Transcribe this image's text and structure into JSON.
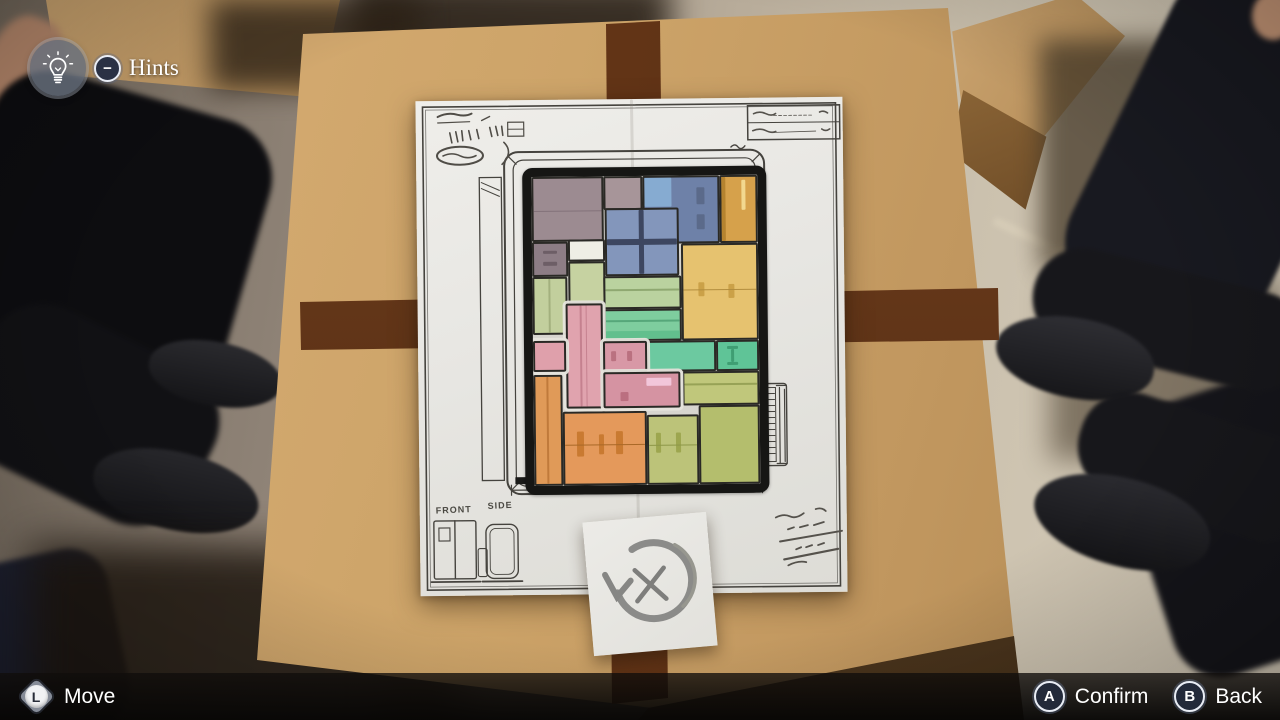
{
  "hud": {
    "hints_label": "Hints",
    "hints_button_glyph": "−",
    "controls": [
      {
        "button": "L",
        "label": "Move",
        "type": "stick"
      },
      {
        "button": "A",
        "label": "Confirm",
        "type": "face-button"
      },
      {
        "button": "B",
        "label": "Back",
        "type": "face-button"
      }
    ]
  },
  "blueprint": {
    "front_label": "FRONT",
    "side_label": "SIDE",
    "note_icon": "rotate-crossed-out",
    "blocks": [
      {
        "name": "mauve-large",
        "x": 0,
        "y": 0,
        "w": 32,
        "h": 21,
        "color": "#9c8b91",
        "marks": [
          {
            "x": 0,
            "y": 52,
            "w": 100,
            "h": 3,
            "c": "#83727a"
          }
        ]
      },
      {
        "name": "mauve-light",
        "x": 32,
        "y": 0,
        "w": 17,
        "h": 11,
        "color": "#a79599",
        "marks": []
      },
      {
        "name": "blue-large",
        "x": 49,
        "y": 0,
        "w": 34,
        "h": 22,
        "color": "#6e81a8",
        "marks": [
          {
            "x": 0,
            "y": 0,
            "w": 37,
            "h": 46,
            "c": "#86abd1"
          },
          {
            "x": 72,
            "y": 16,
            "w": 11,
            "h": 26,
            "c": "#5b6a8a"
          },
          {
            "x": 72,
            "y": 58,
            "w": 11,
            "h": 24,
            "c": "#5b6a8a"
          }
        ]
      },
      {
        "name": "amber-tall",
        "x": 83,
        "y": 0,
        "w": 17,
        "h": 22,
        "color": "#d6a14b",
        "marks": [
          {
            "x": 0,
            "y": 0,
            "w": 12,
            "h": 100,
            "c": "#b5832f"
          },
          {
            "x": 58,
            "y": 4,
            "w": 13,
            "h": 48,
            "c": "#f2d88f"
          }
        ]
      },
      {
        "name": "blue-grid",
        "x": 32.5,
        "y": 10.5,
        "w": 32.5,
        "h": 22,
        "color": "#8396bb",
        "marks": [
          {
            "x": 46,
            "y": 0,
            "w": 7,
            "h": 100,
            "c": "#3d4660"
          },
          {
            "x": 0,
            "y": 45,
            "w": 100,
            "h": 9,
            "c": "#3d4660"
          }
        ]
      },
      {
        "name": "mauve-drawers",
        "x": 0,
        "y": 21,
        "w": 16,
        "h": 11.5,
        "color": "#8d7d85",
        "marks": [
          {
            "x": 28,
            "y": 22,
            "w": 44,
            "h": 11,
            "c": "#6d5e66"
          },
          {
            "x": 28,
            "y": 58,
            "w": 44,
            "h": 11,
            "c": "#6d5e66"
          }
        ]
      },
      {
        "name": "white-box",
        "x": 16,
        "y": 20.5,
        "w": 16.5,
        "h": 7,
        "color": "#efeee5",
        "marks": []
      },
      {
        "name": "green-below-white",
        "x": 16,
        "y": 27.5,
        "w": 16.5,
        "h": 13.5,
        "color": "#c6d2a1",
        "marks": []
      },
      {
        "name": "green-left",
        "x": 0,
        "y": 32.5,
        "w": 15.5,
        "h": 18.5,
        "color": "#c2cf9d",
        "marks": [
          {
            "x": 46,
            "y": 0,
            "w": 6,
            "h": 100,
            "c": "#a3b07e"
          }
        ]
      },
      {
        "name": "green-horiz",
        "x": 31.5,
        "y": 32.5,
        "w": 34.5,
        "h": 10.5,
        "color": "#bad29f",
        "marks": [
          {
            "x": 0,
            "y": 38,
            "w": 100,
            "h": 7,
            "c": "#8fa871"
          }
        ]
      },
      {
        "name": "mint-horiz",
        "x": 31.5,
        "y": 43,
        "w": 34.5,
        "h": 10.5,
        "color": "#7ecd9e",
        "marks": [
          {
            "x": 0,
            "y": 32,
            "w": 100,
            "h": 6,
            "c": "#56a77a"
          },
          {
            "x": 0,
            "y": 72,
            "w": 100,
            "h": 28,
            "c": "#62bf8d"
          }
        ]
      },
      {
        "name": "yellow-large",
        "x": 66,
        "y": 22,
        "w": 34,
        "h": 31.5,
        "color": "#e6c26f",
        "marks": [
          {
            "x": 20,
            "y": 40,
            "w": 8,
            "h": 15,
            "c": "#cba148"
          },
          {
            "x": 62,
            "y": 42,
            "w": 8,
            "h": 15,
            "c": "#cba148"
          },
          {
            "x": 0,
            "y": 47,
            "w": 100,
            "h": 1.6,
            "c": "#b28d3e"
          }
        ]
      },
      {
        "name": "teal-mid",
        "x": 50.5,
        "y": 53.5,
        "w": 30.5,
        "h": 10,
        "color": "#6cc9a0",
        "marks": []
      },
      {
        "name": "teal-right",
        "x": 81,
        "y": 53.5,
        "w": 19,
        "h": 10,
        "color": "#5fc497",
        "marks": [
          {
            "x": 24,
            "y": 14,
            "w": 26,
            "h": 12,
            "c": "#3f9e73"
          },
          {
            "x": 24,
            "y": 72,
            "w": 26,
            "h": 12,
            "c": "#3f9e73"
          },
          {
            "x": 33,
            "y": 26,
            "w": 9,
            "h": 46,
            "c": "#3f9e73"
          }
        ]
      },
      {
        "name": "olive-horiz",
        "x": 66,
        "y": 63.5,
        "w": 34,
        "h": 11,
        "color": "#c0c77b",
        "marks": [
          {
            "x": 0,
            "y": 34,
            "w": 100,
            "h": 6,
            "c": "#97a256"
          }
        ]
      },
      {
        "name": "orange-slim",
        "x": 0,
        "y": 64,
        "w": 13,
        "h": 36,
        "color": "#e09a58",
        "marks": [
          {
            "x": 44,
            "y": 0,
            "w": 6,
            "h": 100,
            "c": "#c07a3b"
          }
        ]
      },
      {
        "name": "orange-large",
        "x": 13,
        "y": 76,
        "w": 37,
        "h": 24,
        "color": "#e4995b",
        "marks": [
          {
            "x": 14,
            "y": 26,
            "w": 9,
            "h": 36,
            "c": "#c97a31"
          },
          {
            "x": 42,
            "y": 30,
            "w": 7,
            "h": 28,
            "c": "#c97a31"
          },
          {
            "x": 64,
            "y": 26,
            "w": 8,
            "h": 33,
            "c": "#c97a31"
          },
          {
            "x": 0,
            "y": 44,
            "w": 100,
            "h": 1.8,
            "c": "#a96827"
          }
        ]
      },
      {
        "name": "olive-mid",
        "x": 50,
        "y": 77.5,
        "w": 23,
        "h": 22.5,
        "color": "#bcc379",
        "marks": [
          {
            "x": 14,
            "y": 24,
            "w": 11,
            "h": 30,
            "c": "#9da64f"
          },
          {
            "x": 56,
            "y": 24,
            "w": 11,
            "h": 30,
            "c": "#9da64f"
          },
          {
            "x": 0,
            "y": 42,
            "w": 100,
            "h": 2,
            "c": "#8d9748"
          }
        ]
      },
      {
        "name": "olive-right",
        "x": 73,
        "y": 74.5,
        "w": 27,
        "h": 25.5,
        "color": "#b4be6d",
        "marks": []
      },
      {
        "name": "pink-upright",
        "x": 14.5,
        "y": 41,
        "w": 16.5,
        "h": 34,
        "color": "#e0a3ae",
        "halo": true,
        "marks": [
          {
            "x": 38,
            "y": 0,
            "w": 6,
            "h": 100,
            "c": "#c5818f"
          },
          {
            "x": 56,
            "y": 0,
            "w": 3,
            "h": 100,
            "c": "#c5818f"
          }
        ]
      },
      {
        "name": "pink-left-arm",
        "x": 0,
        "y": 53,
        "w": 14.5,
        "h": 10,
        "color": "#dfa0ab",
        "halo": true,
        "marks": []
      },
      {
        "name": "pink-handle-box",
        "x": 31,
        "y": 53.5,
        "w": 19.5,
        "h": 10,
        "color": "#d898a6",
        "halo": true,
        "marks": [
          {
            "x": 16,
            "y": 30,
            "w": 11,
            "h": 34,
            "c": "#ba7180"
          },
          {
            "x": 56,
            "y": 30,
            "w": 11,
            "h": 34,
            "c": "#ba7180"
          }
        ]
      },
      {
        "name": "pink-wide",
        "x": 31,
        "y": 63.5,
        "w": 34,
        "h": 11.5,
        "color": "#d593a2",
        "halo": true,
        "marks": [
          {
            "x": 56,
            "y": 12,
            "w": 34,
            "h": 26,
            "c": "#f2c6da"
          },
          {
            "x": 20,
            "y": 55,
            "w": 12,
            "h": 30,
            "c": "#bb6f80"
          }
        ]
      }
    ]
  },
  "palette": {
    "cardboard": "#c9a06b",
    "tape": "#5e3317",
    "paper": "#e9e8e4",
    "ink": "#3c3a36",
    "hud_text": "#ffffff"
  }
}
